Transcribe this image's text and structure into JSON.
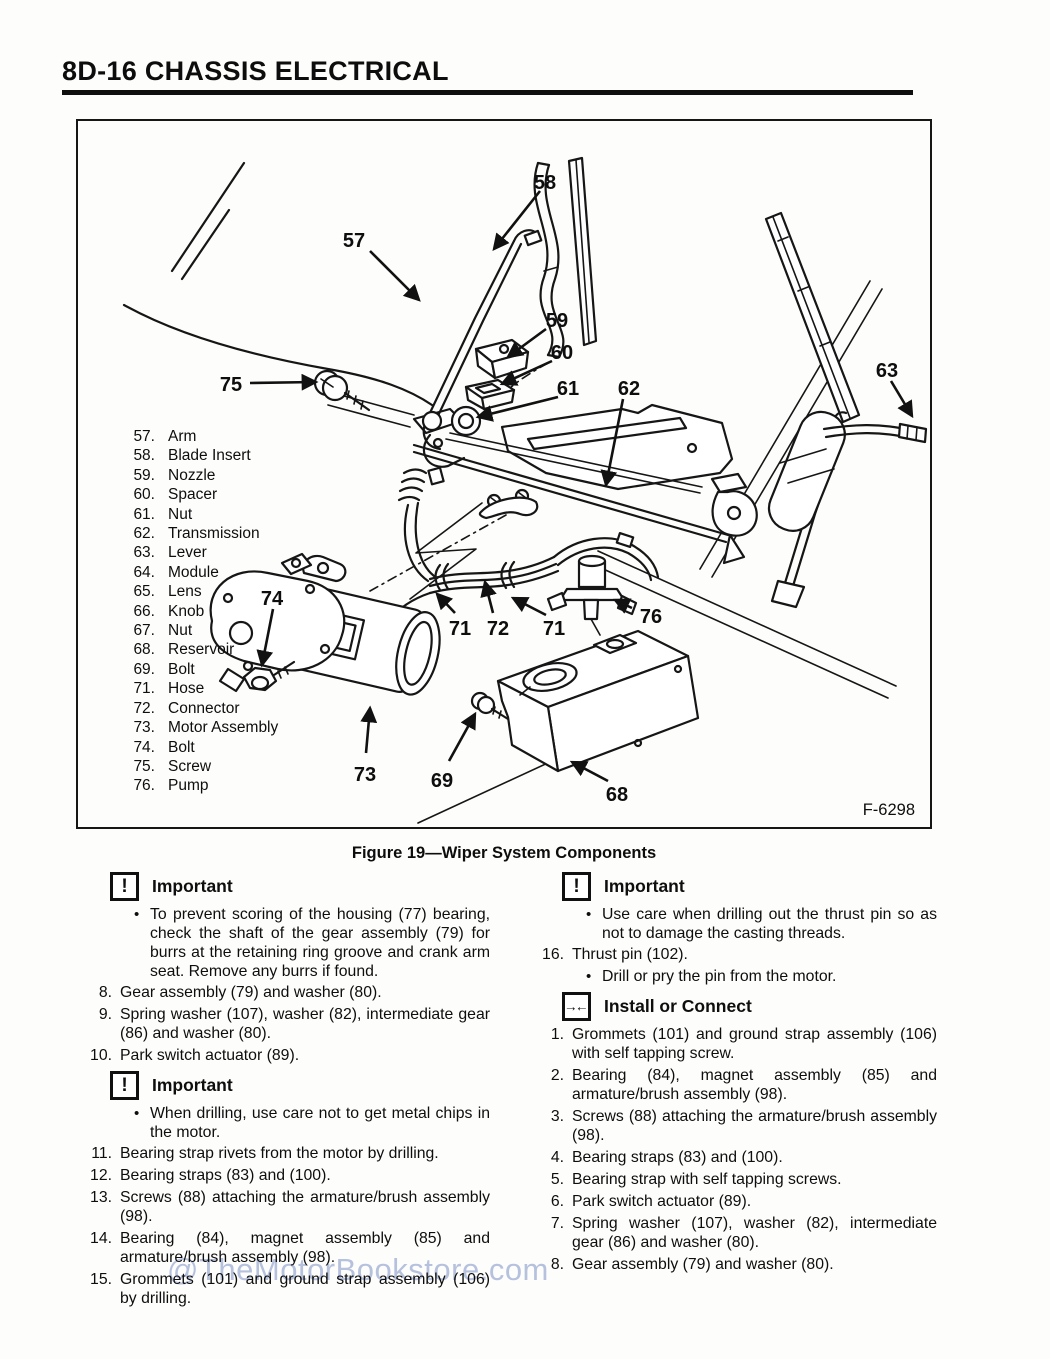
{
  "page": {
    "header": "8D-16 CHASSIS ELECTRICAL",
    "watermark": "@TheMotorBookstore.com"
  },
  "figure": {
    "caption": "Figure 19—Wiper System Components",
    "code": "F-6298",
    "parts_list": [
      {
        "num": "57.",
        "label": "Arm"
      },
      {
        "num": "58.",
        "label": "Blade Insert"
      },
      {
        "num": "59.",
        "label": "Nozzle"
      },
      {
        "num": "60.",
        "label": "Spacer"
      },
      {
        "num": "61.",
        "label": "Nut"
      },
      {
        "num": "62.",
        "label": "Transmission"
      },
      {
        "num": "63.",
        "label": "Lever"
      },
      {
        "num": "64.",
        "label": "Module"
      },
      {
        "num": "65.",
        "label": "Lens"
      },
      {
        "num": "66.",
        "label": "Knob"
      },
      {
        "num": "67.",
        "label": "Nut"
      },
      {
        "num": "68.",
        "label": "Reservoir"
      },
      {
        "num": "69.",
        "label": "Bolt"
      },
      {
        "num": "71.",
        "label": "Hose"
      },
      {
        "num": "72.",
        "label": "Connector"
      },
      {
        "num": "73.",
        "label": "Motor Assembly"
      },
      {
        "num": "74.",
        "label": "Bolt"
      },
      {
        "num": "75.",
        "label": "Screw"
      },
      {
        "num": "76.",
        "label": "Pump"
      }
    ],
    "callouts": {
      "c57": "57",
      "c58": "58",
      "c59": "59",
      "c60": "60",
      "c61": "61",
      "c62": "62",
      "c63": "63",
      "c68": "68",
      "c69": "69",
      "c71a": "71",
      "c71b": "71",
      "c72": "72",
      "c73": "73",
      "c74": "74",
      "c75": "75",
      "c76": "76"
    }
  },
  "icons": {
    "important_glyph": "!",
    "install_glyph": "→←"
  },
  "procedure": {
    "left": [
      {
        "type": "header",
        "icon": "important",
        "text": "Important"
      },
      {
        "type": "bullet",
        "text": "To prevent scoring of the housing (77) bearing, check the shaft of the gear assembly (79) for burrs at the retaining ring groove and crank arm seat. Remove any burrs if found."
      },
      {
        "type": "item",
        "num": "8.",
        "text": "Gear assembly (79) and washer (80)."
      },
      {
        "type": "item",
        "num": "9.",
        "text": "Spring washer (107), washer (82), intermediate gear (86) and washer (80)."
      },
      {
        "type": "item",
        "num": "10.",
        "text": "Park switch actuator (89)."
      },
      {
        "type": "header",
        "icon": "important",
        "text": "Important"
      },
      {
        "type": "bullet",
        "text": "When drilling, use care not to get metal chips in the motor."
      },
      {
        "type": "item",
        "num": "11.",
        "text": "Bearing strap rivets from the motor by drilling."
      },
      {
        "type": "item",
        "num": "12.",
        "text": "Bearing straps (83) and (100)."
      },
      {
        "type": "item",
        "num": "13.",
        "text": "Screws (88) attaching the armature/brush assembly (98)."
      },
      {
        "type": "item",
        "num": "14.",
        "text": "Bearing (84), magnet assembly (85) and armature/brush assembly (98)."
      },
      {
        "type": "item",
        "num": "15.",
        "text": "Grommets (101) and ground strap assembly (106) by drilling."
      }
    ],
    "right": [
      {
        "type": "header",
        "icon": "important",
        "text": "Important"
      },
      {
        "type": "bullet",
        "text": "Use care when drilling out the thrust pin so as not to damage the casting threads."
      },
      {
        "type": "item",
        "num": "16.",
        "text": "Thrust pin (102)."
      },
      {
        "type": "bullet",
        "text": "Drill or pry the pin from the motor."
      },
      {
        "type": "header",
        "icon": "install",
        "text": "Install or Connect"
      },
      {
        "type": "item",
        "num": "1.",
        "text": "Grommets (101) and ground strap assembly (106) with self tapping screw."
      },
      {
        "type": "item",
        "num": "2.",
        "text": "Bearing (84), magnet assembly (85) and armature/brush assembly (98)."
      },
      {
        "type": "item",
        "num": "3.",
        "text": "Screws (88) attaching the armature/brush assembly (98)."
      },
      {
        "type": "item",
        "num": "4.",
        "text": "Bearing straps (83) and (100)."
      },
      {
        "type": "item",
        "num": "5.",
        "text": "Bearing strap with self tapping screws."
      },
      {
        "type": "item",
        "num": "6.",
        "text": "Park switch actuator (89)."
      },
      {
        "type": "item",
        "num": "7.",
        "text": "Spring washer (107), washer (82), intermediate gear (86) and washer (80)."
      },
      {
        "type": "item",
        "num": "8.",
        "text": "Gear assembly (79) and washer (80)."
      }
    ]
  }
}
